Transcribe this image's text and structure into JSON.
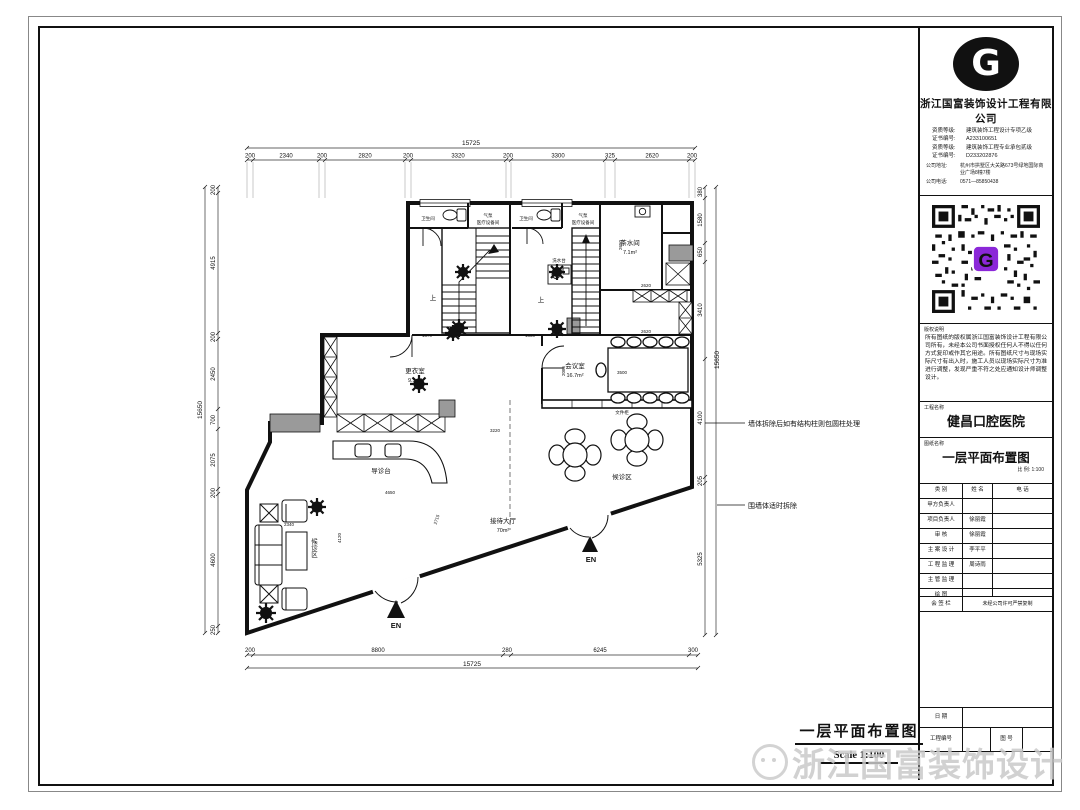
{
  "page": {
    "watermark": "浙江国富装饰设计",
    "drawing_title": "一层平面布置图",
    "drawing_scale": "Scale  1:100"
  },
  "title_block": {
    "logo_letter": "G",
    "company": "浙江国富装饰设计工程有限公司",
    "cred1_label": "资质等级:",
    "cred1": "建筑装饰工程设计专项乙级",
    "cred2_label": "证书编号:",
    "cred2": "A233100651",
    "cred3_label": "资质等级:",
    "cred3": "建筑装饰工程专业承包贰级",
    "cred4_label": "证书编号:",
    "cred4": "D233202876",
    "address_label": "公司地址:",
    "address": "杭州市拱墅区大关路673号绿地国际商业广场8幢7楼",
    "phone_label": "公司电话:",
    "phone": "0571—85850438",
    "copyright_label": "版权说明",
    "copyright_text": "所有图纸的版权属浙江国富装饰设计工程有限公司所有，未经本公司书面授权任何人不得以任何方式复印或作其它用途。所有图纸尺寸与现场实际尺寸有出入时，施工人员以现场实际尺寸为准进行调整，发现严重不符之处应通知设计师调整设计。",
    "project_label": "工程名称",
    "project_name": "健昌口腔医院",
    "drawing_label": "图纸名称",
    "drawing_name": "一层平面布置图",
    "scale_label": "比  例: 1:100",
    "table_headers": [
      "类    别",
      "姓  名",
      "电    话"
    ],
    "rows": [
      {
        "role": "甲方负责人",
        "name": "",
        "phone": ""
      },
      {
        "role": "项目负责人",
        "name": "徐丽霞",
        "phone": ""
      },
      {
        "role": "审      核",
        "name": "徐丽霞",
        "phone": ""
      },
      {
        "role": "主 案 设 计",
        "name": "李平平",
        "phone": ""
      },
      {
        "role": "工 程 监 理",
        "name": "周诗雨",
        "phone": ""
      },
      {
        "role": "主 管 监 理",
        "name": "",
        "phone": ""
      },
      {
        "role": "绘      图",
        "name": "",
        "phone": ""
      }
    ],
    "sign_label": "会 签 栏",
    "sign_note": "未经公司许可严禁复制",
    "date_label": "日    期",
    "project_no_label": "工程编号",
    "drawing_no_label": "图  号"
  },
  "plan": {
    "dims": {
      "top_total": "15725",
      "top": [
        "200",
        "2340",
        "200",
        "2820",
        "200",
        "3320",
        "200",
        "3300",
        "325",
        "2620",
        "200"
      ],
      "left_total": "15650",
      "left": [
        "200",
        "4915",
        "200",
        "2450",
        "700",
        "2075",
        "200",
        "4600",
        "250"
      ],
      "right_total": "15650",
      "right": [
        "380",
        "1580",
        "650",
        "3410",
        "4100",
        "205",
        "5325"
      ],
      "bottom_total": "15725",
      "bottom": [
        "200",
        "8800",
        "280",
        "6245",
        "300"
      ],
      "inner": [
        "1370",
        "1330",
        "2650",
        "2620",
        "2620",
        "2085",
        "3500",
        "4650",
        "4120",
        "2715",
        "3220",
        "2340"
      ]
    },
    "labels": {
      "toilet": "卫生间",
      "pump": "气泵",
      "equip": "医疗设备间",
      "tea_room": "茶水间",
      "tea_area": "7.1m²",
      "up": "上",
      "sink": "洗水台",
      "meeting": "会议室",
      "meeting_area": "16.7m²",
      "changing": "更衣室",
      "changing_area": "9.3m²",
      "file_cabinet": "文件柜",
      "waiting": "候诊区",
      "reception_desk": "导诊台",
      "hall": "接待大厅",
      "hall_area": "70m²",
      "en": "EN",
      "note_wall": "墙体拆除后如有结构柱则包圆柱处理",
      "note_demolish": "围墙体适时拆除"
    }
  }
}
